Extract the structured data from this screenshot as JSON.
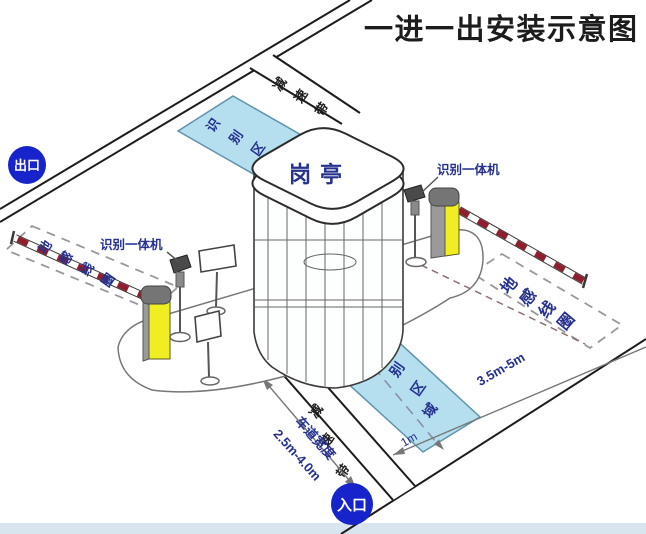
{
  "title": "一进一出安装示意图",
  "badges": {
    "exit": "出口",
    "entrance": "入口"
  },
  "booth": {
    "label": "岗亭"
  },
  "zones": {
    "exit_label": "识别区",
    "entry_label": "识别区域"
  },
  "speed_bumps": {
    "top": "减速带",
    "bottom": "减速带"
  },
  "ground_loops": {
    "left": "地感线圈",
    "right": "地感线圈"
  },
  "cameras": {
    "left": "识别一体机",
    "right": "识别一体机"
  },
  "dimensions": {
    "loop_length": "3.5m-5m",
    "lane_width_label": "车道宽度",
    "lane_width_value": "2.5m-4.0m",
    "zone_to_gate": "1m"
  },
  "colors": {
    "label_navy": "#25318f",
    "zone_fill": "#b5dfee",
    "post_yellow": "#f0ee22",
    "arm_stripe_red": "#8f1f2c",
    "badge_blue": "#1724cb",
    "title_black": "#1c1c1c"
  }
}
